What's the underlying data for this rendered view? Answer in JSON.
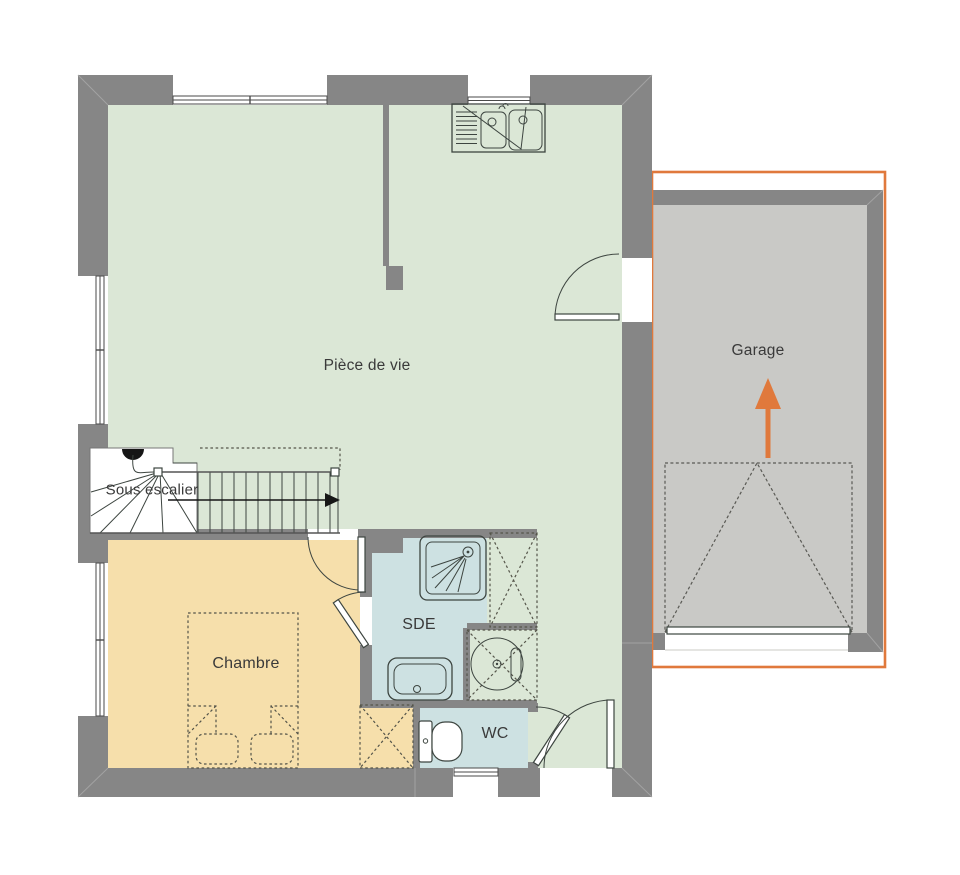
{
  "title": "Plan de maison - rez-de-chaussée",
  "colors": {
    "wall": "#868686",
    "wall-line": "#a2a2a2",
    "floor-living": "#dbe7d6",
    "floor-bedroom": "#f6dfab",
    "floor-bath": "#cde1e2",
    "floor-garage": "#c9c9c6",
    "accent-orange": "#e0793c",
    "stroke-dark": "#3d4540",
    "stroke-dash": "#55554a",
    "text": "#3a3a3a"
  },
  "rooms": [
    {
      "id": "piece-de-vie",
      "label": "Pièce de vie"
    },
    {
      "id": "garage",
      "label": "Garage"
    },
    {
      "id": "chambre",
      "label": "Chambre"
    },
    {
      "id": "sde",
      "label": "SDE"
    },
    {
      "id": "wc",
      "label": "WC"
    },
    {
      "id": "sous-escalier",
      "label": "Sous escalier"
    }
  ]
}
